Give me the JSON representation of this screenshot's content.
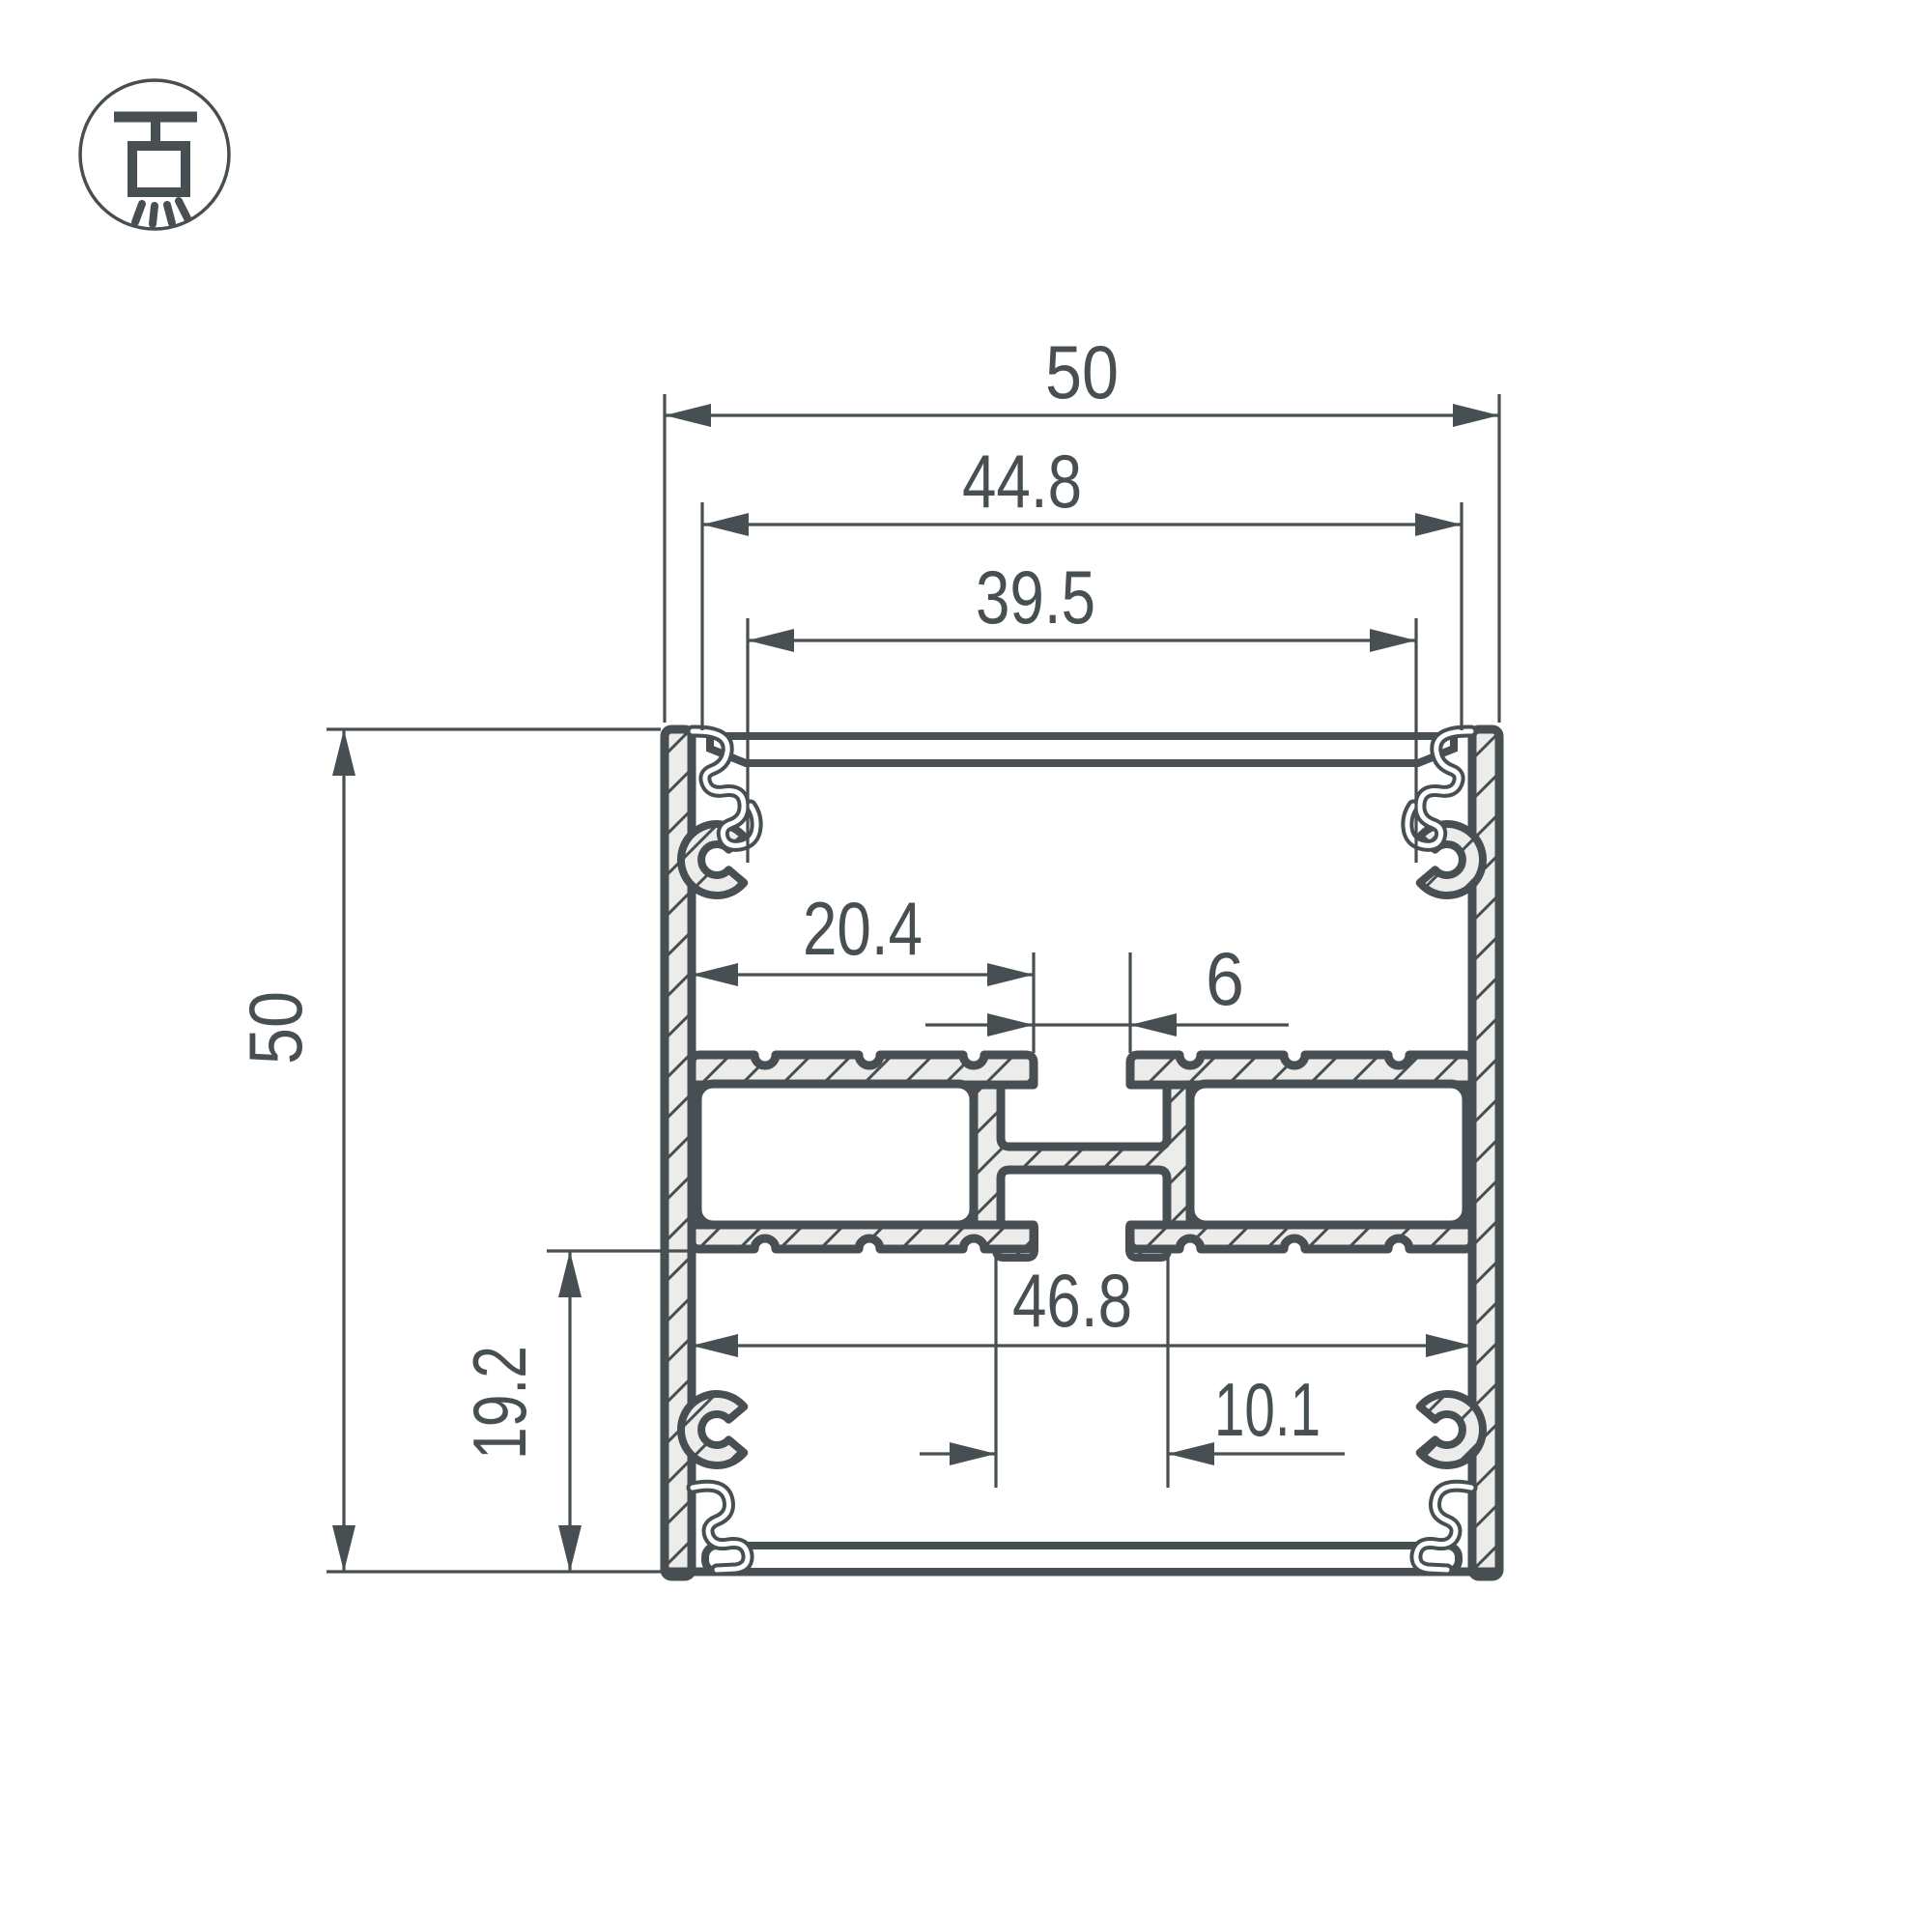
{
  "drawing": {
    "type": "technical-cross-section",
    "subject": "aluminium profile cross-section with dimensions",
    "units_implied": "mm",
    "dimensions": {
      "outer_width": "50",
      "top_inner_width": "44.8",
      "top_opening_width": "39.5",
      "overall_height": "50",
      "shelf_left_width": "20.4",
      "center_slot_width": "6",
      "lower_inner_width": "46.8",
      "bottom_offset_height": "19.2",
      "center_channel_width": "10.1"
    }
  },
  "icon": {
    "name": "pendant-ceiling-light-icon",
    "meaning": "surface/pendant mounted luminaire"
  },
  "colors": {
    "line": "#474f52",
    "hatch_fill": "#ecedeb",
    "background": "#ffffff"
  }
}
